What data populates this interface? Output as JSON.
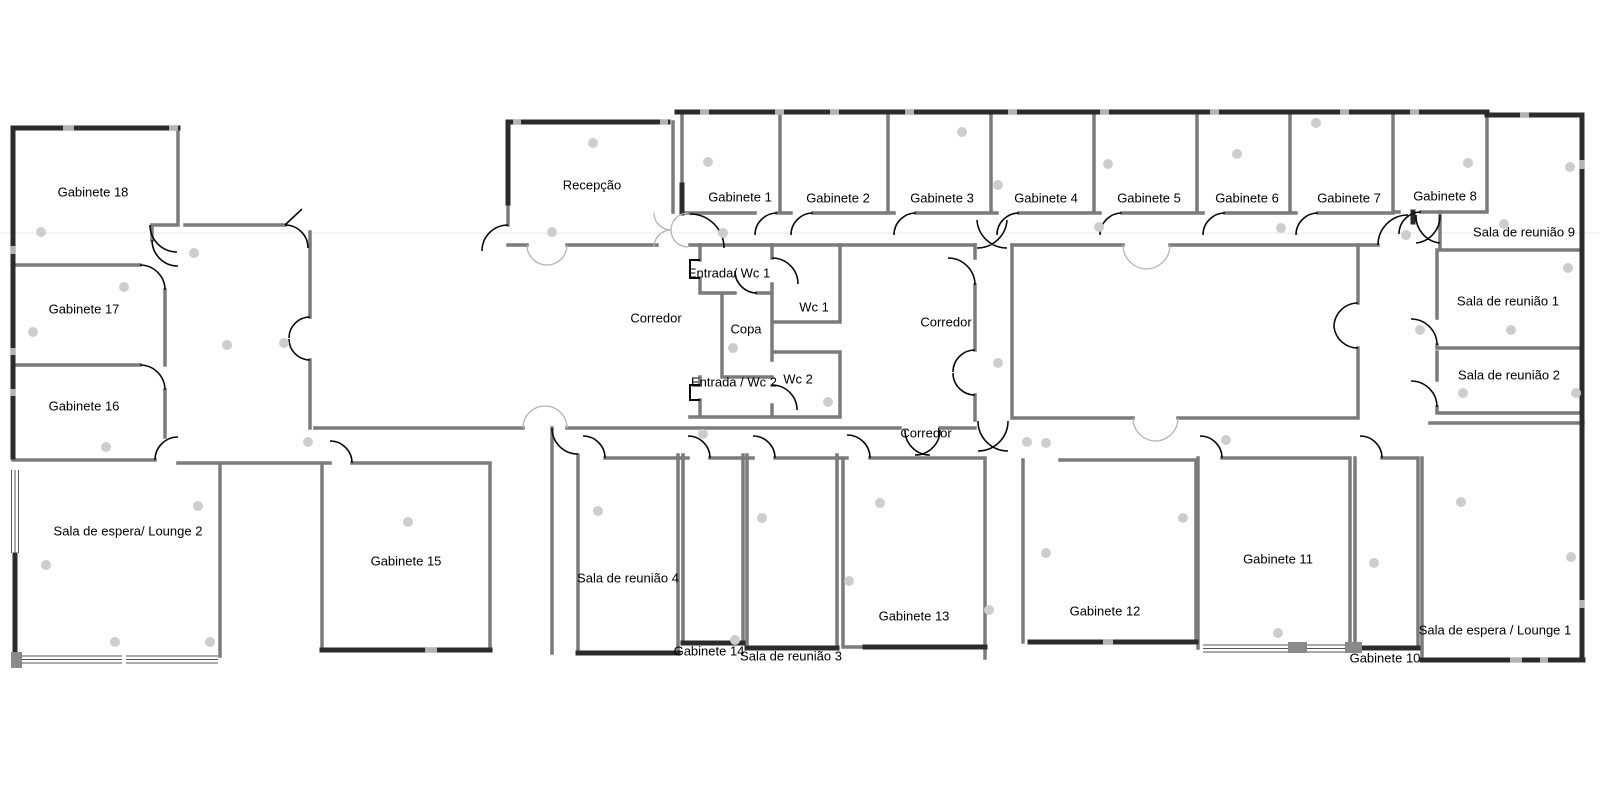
{
  "plan_title": "Office floor plan",
  "palette": {
    "background": "#ffffff",
    "interior_wall": "#7b7b7b",
    "exterior_wall": "#2b2b2b",
    "wall_gap": "#b3b3b3",
    "door_arc": "#0a0a0a",
    "double_door_arc": "#b5b5b5",
    "ceiling_dot": "#cdcdcd",
    "label_text": "#000000"
  },
  "rooms": [
    {
      "label": "Gabinete 18",
      "x": 93,
      "y": 193
    },
    {
      "label": "Gabinete 17",
      "x": 84,
      "y": 310
    },
    {
      "label": "Gabinete 16",
      "x": 84,
      "y": 407
    },
    {
      "label": "Sala de espera/ Lounge 2",
      "x": 128,
      "y": 532
    },
    {
      "label": "Gabinete 15",
      "x": 406,
      "y": 562
    },
    {
      "label": "Recepção",
      "x": 592,
      "y": 186
    },
    {
      "label": "Corredor",
      "x": 656,
      "y": 319
    },
    {
      "label": "Entrada/ Wc 1",
      "x": 729,
      "y": 274
    },
    {
      "label": "Copa",
      "x": 746,
      "y": 330
    },
    {
      "label": "Wc 1",
      "x": 814,
      "y": 308
    },
    {
      "label": "Entrada / Wc 2",
      "x": 734,
      "y": 383
    },
    {
      "label": "Wc 2",
      "x": 798,
      "y": 380
    },
    {
      "label": "Corredor",
      "x": 946,
      "y": 323
    },
    {
      "label": "Corredor",
      "x": 926,
      "y": 434
    },
    {
      "label": "Gabinete 1",
      "x": 740,
      "y": 198
    },
    {
      "label": "Gabinete 2",
      "x": 838,
      "y": 199
    },
    {
      "label": "Gabinete 3",
      "x": 942,
      "y": 199
    },
    {
      "label": "Gabinete 4",
      "x": 1046,
      "y": 199
    },
    {
      "label": "Gabinete 5",
      "x": 1149,
      "y": 199
    },
    {
      "label": "Gabinete 6",
      "x": 1247,
      "y": 199
    },
    {
      "label": "Gabinete 7",
      "x": 1349,
      "y": 199
    },
    {
      "label": "Gabinete 8",
      "x": 1445,
      "y": 197
    },
    {
      "label": "Sala de reunião 9",
      "x": 1524,
      "y": 233
    },
    {
      "label": "Sala de reunião 1",
      "x": 1508,
      "y": 302
    },
    {
      "label": "Sala de reunião 2",
      "x": 1509,
      "y": 376
    },
    {
      "label": "Sala de reunião 4",
      "x": 628,
      "y": 579
    },
    {
      "label": "Gabinete 14",
      "x": 709,
      "y": 652
    },
    {
      "label": "Sala de reunião 3",
      "x": 791,
      "y": 657
    },
    {
      "label": "Gabinete 13",
      "x": 914,
      "y": 617
    },
    {
      "label": "Gabinete 12",
      "x": 1105,
      "y": 612
    },
    {
      "label": "Gabinete 11",
      "x": 1278,
      "y": 560
    },
    {
      "label": "Gabinete 10",
      "x": 1385,
      "y": 659
    },
    {
      "label": "Sala de espera / Lounge 1",
      "x": 1495,
      "y": 631
    }
  ],
  "plan_markers": {
    "dots": [
      [
        41,
        232
      ],
      [
        124,
        287
      ],
      [
        33,
        332
      ],
      [
        106,
        447
      ],
      [
        194,
        253
      ],
      [
        227,
        345
      ],
      [
        284,
        343
      ],
      [
        308,
        442
      ],
      [
        552,
        232
      ],
      [
        593,
        143
      ],
      [
        723,
        233
      ],
      [
        708,
        162
      ],
      [
        962,
        132
      ],
      [
        998,
        185
      ],
      [
        1108,
        164
      ],
      [
        1237,
        154
      ],
      [
        1099,
        227
      ],
      [
        1316,
        123
      ],
      [
        1468,
        163
      ],
      [
        1570,
        167
      ],
      [
        1504,
        224
      ],
      [
        1281,
        228
      ],
      [
        1406,
        235
      ],
      [
        1568,
        268
      ],
      [
        733,
        348
      ],
      [
        828,
        402
      ],
      [
        703,
        434
      ],
      [
        998,
        363
      ],
      [
        1027,
        442
      ],
      [
        1226,
        440
      ],
      [
        1420,
        330
      ],
      [
        1511,
        330
      ],
      [
        1463,
        393
      ],
      [
        1576,
        393
      ],
      [
        115,
        642
      ],
      [
        210,
        642
      ],
      [
        198,
        506
      ],
      [
        46,
        565
      ],
      [
        408,
        522
      ],
      [
        598,
        511
      ],
      [
        762,
        518
      ],
      [
        880,
        503
      ],
      [
        735,
        640
      ],
      [
        849,
        581
      ],
      [
        989,
        610
      ],
      [
        1046,
        443
      ],
      [
        1183,
        518
      ],
      [
        1046,
        553
      ],
      [
        1278,
        633
      ],
      [
        1374,
        563
      ],
      [
        1461,
        502
      ],
      [
        1571,
        557
      ]
    ]
  }
}
